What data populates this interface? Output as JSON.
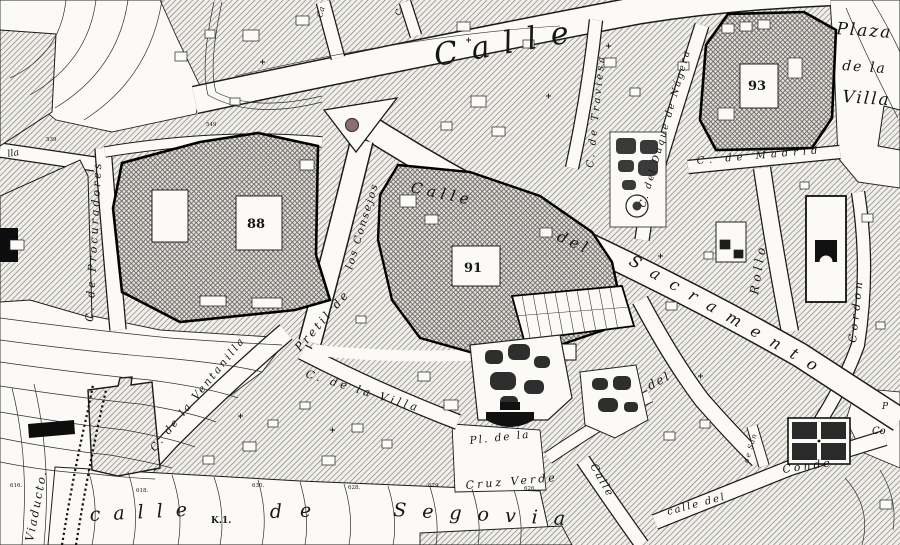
{
  "labels": {
    "calle_mayor": "Calle",
    "plaza_villa_1": "Plaza",
    "plaza_villa_2": "de la",
    "plaza_villa_3": "Villa",
    "block_93": "93",
    "block_88": "88",
    "block_91": "91",
    "traviesa": "C. de Traviesa",
    "duque_nagera": "C. del Duque de Nágera",
    "madrid": "C. de Madrid",
    "procuradores": "C. de Procuradores",
    "sacramento_1": "Calle",
    "sacramento_2": "del",
    "sacramento_3": "Sacramento",
    "rollo": "Rollo",
    "cordon": "Cordon",
    "pretil_1": "Pretil de",
    "pretil_2": "los Consejos",
    "ventanilla": "C. de la Ventanilla",
    "villa_street": "C. de la Villa",
    "cruz_verde_plaza_1": "Pl. de la",
    "cruz_verde_plaza_2": "Cruz Verde",
    "viaducto": "Viaducto.",
    "segovia_1": "calle",
    "segovia_2": "de",
    "segovia_3": "Segovia",
    "km_marker": "K.1.",
    "conde": "Conde",
    "calle_del_se": "calle del",
    "calle_se": "Calle",
    "del_fork": "del",
    "de_san": "de San",
    "edge_p": "P",
    "edge_co": "Co",
    "stub_ca": "Ca",
    "stub_c": "C.",
    "edge_lla": "lla"
  },
  "elev": [
    "549",
    "539",
    "616.",
    "618.",
    "630.",
    "628.",
    "629.",
    "626."
  ],
  "colors": {
    "paper": "#fbfaf7",
    "ink": "#1b1b1b",
    "block_hatch": "#777777",
    "monument_hatch": "#444444",
    "fountain_dot": "#8d6e6e"
  }
}
